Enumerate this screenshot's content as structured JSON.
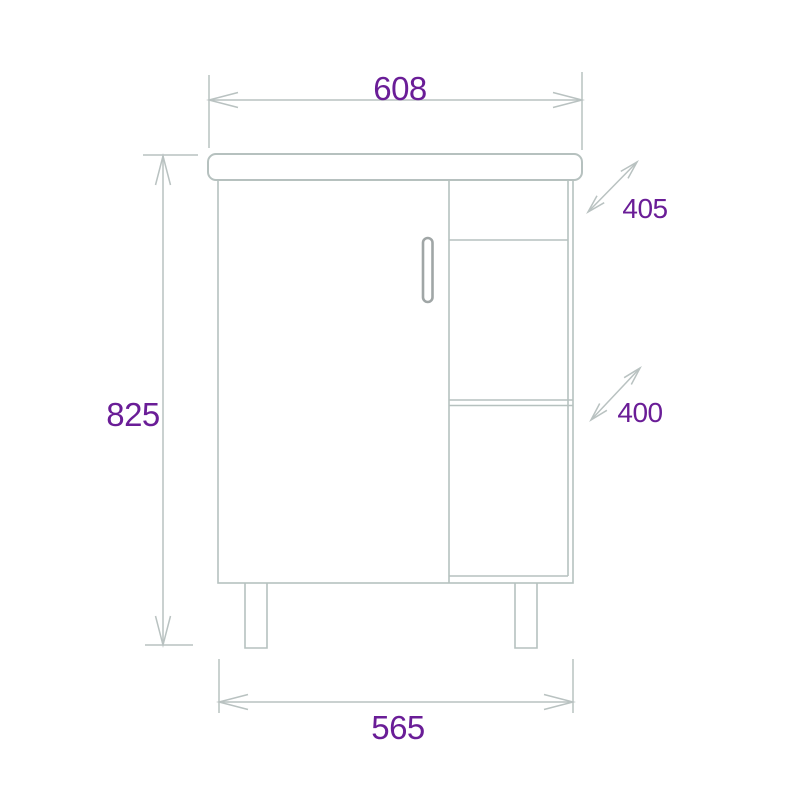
{
  "drawing": {
    "subject": "vanity-cabinet-front-elevation-dimension-drawing",
    "colors": {
      "line": "#b6c1bf",
      "handle_stroke": "#a0a6a6",
      "dimension_text": "#6a1d97",
      "background": "#ffffff"
    },
    "dimensions": {
      "overall_width": "608",
      "overall_height": "825",
      "top_depth": "405",
      "shelf_depth": "400",
      "body_width": "565"
    }
  }
}
